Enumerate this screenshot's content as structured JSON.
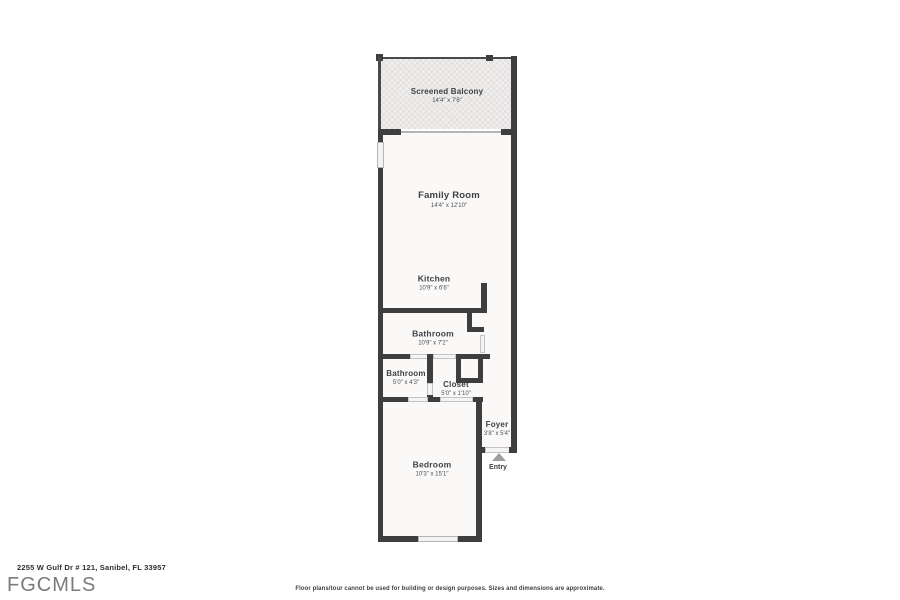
{
  "floorplan": {
    "colors": {
      "wall": "#3e3e3e",
      "room_fill": "#faf9f8",
      "balcony_fill": "#efeeed",
      "door_window": "#f2f2f2",
      "entry_arrow": "#9e9e9e",
      "label_text": "#3d4247"
    },
    "rooms": [
      {
        "id": "screened-balcony",
        "name": "Screened Balcony",
        "dims": "14'4\" x 7'6\""
      },
      {
        "id": "family-room",
        "name": "Family Room",
        "dims": "14'4\" x 12'10\""
      },
      {
        "id": "kitchen",
        "name": "Kitchen",
        "dims": "10'9\" x 6'6\""
      },
      {
        "id": "bathroom-1",
        "name": "Bathroom",
        "dims": "10'9\" x 7'2\""
      },
      {
        "id": "bathroom-2",
        "name": "Bathroom",
        "dims": "5'0\" x 4'3\""
      },
      {
        "id": "closet",
        "name": "Closet",
        "dims": "5'0\" x 1'10\""
      },
      {
        "id": "foyer",
        "name": "Foyer",
        "dims": "3'8\" x 5'4\""
      },
      {
        "id": "bedroom",
        "name": "Bedroom",
        "dims": "10'3\" x 15'1\""
      }
    ],
    "entry_label": "Entry"
  },
  "footer": {
    "address": "2255 W Gulf Dr # 121, Sanibel, FL 33957",
    "logo": "FGCMLS",
    "disclaimer": "Floor plans/tour cannot be used for building or design purposes. Sizes and dimensions are approximate."
  }
}
